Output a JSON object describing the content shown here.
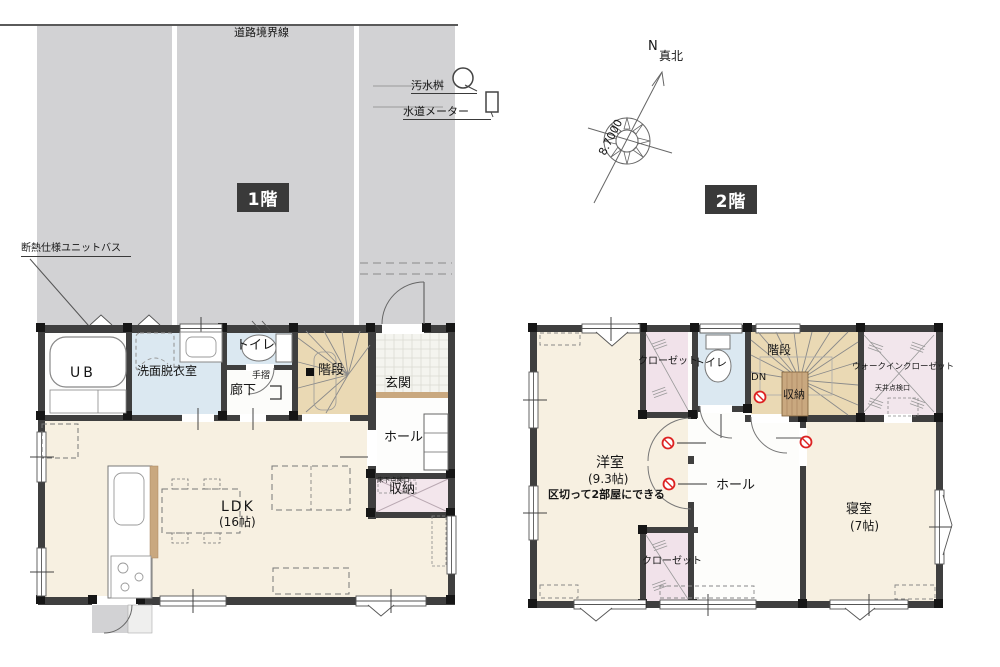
{
  "site": {
    "road_boundary": "道路境界線",
    "sewage_basin": "汚水桝",
    "water_meter": "水道メーター",
    "bath_note": "断熱仕様ユニットバス"
  },
  "compass": {
    "n": "N",
    "true_north": "真北",
    "bearing": "8.7000"
  },
  "floor1": {
    "badge": "1階",
    "rooms": {
      "ub": "UB",
      "washroom": "洗面脱衣室",
      "toilet": "トイレ",
      "stairs": "階段",
      "entrance": "玄関",
      "hall": "ホール",
      "corridor": "廊下",
      "storage": "収納",
      "ldk": "LDK",
      "ldk_size": "(16帖)"
    },
    "annotations": {
      "handrail": "手摺",
      "underfloor_access": "床下点検口"
    }
  },
  "floor2": {
    "badge": "2階",
    "rooms": {
      "western_room": "洋室",
      "western_room_size": "(9.3帖)",
      "western_room_note": "区切って2部屋にできる",
      "closet_top": "クローゼット",
      "closet_bottom": "クローゼット",
      "toilet": "トイレ",
      "stairs": "階段",
      "storage": "収納",
      "wic": "ウォークインクローゼット",
      "hall": "ホール",
      "bedroom": "寝室",
      "bedroom_size": "(7帖)"
    },
    "annotations": {
      "down": "DN",
      "ceiling_access": "天井点検口"
    }
  },
  "colors": {
    "wall": "#3f3f3f",
    "floor_cream": "#f7f0e1",
    "floor_blue": "#dbe8f1",
    "floor_tan": "#ead9b4",
    "floor_pink": "#f1e2ea",
    "site_gray": "#d2d2d4",
    "wood": "#c9a87f",
    "alarm_red": "#dd2222"
  }
}
